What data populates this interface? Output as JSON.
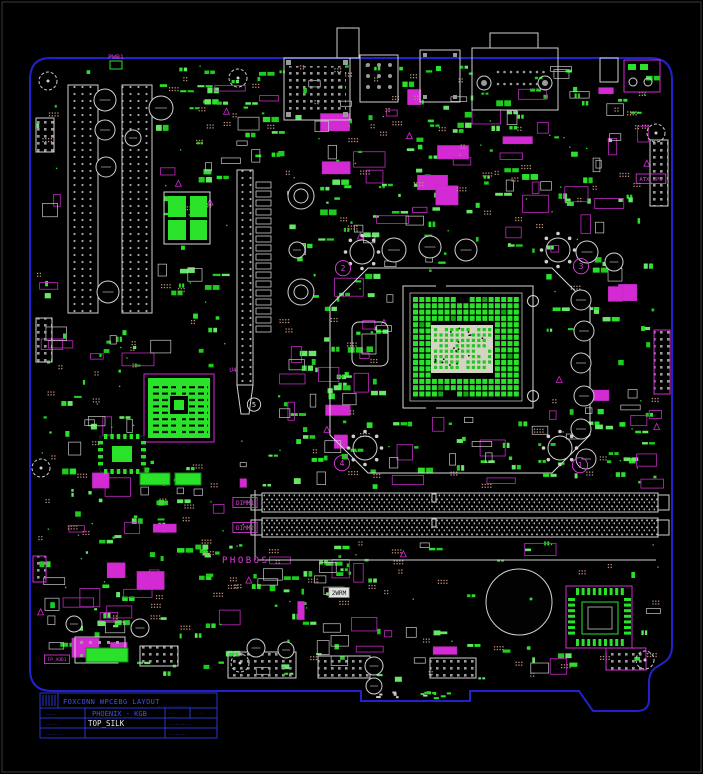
{
  "page": {
    "width": 703,
    "height": 774,
    "background": "#000000",
    "frame_color": "#3a3a3a"
  },
  "colors": {
    "board_outline": "#2222cc",
    "title_blue": "#2a35d0",
    "title_text": "#4050f5",
    "silk_white": "#d4d4d4",
    "component_green": "#2be22b",
    "component_green_dim": "#1ec21e",
    "magenta": "#d32ad3",
    "tan_via": "#c08f7a",
    "pin_gray": "#9a9a9a",
    "layer_text_white": "#e8e8e8"
  },
  "title_block": {
    "project": "FOXCONN WPCEBG LAYOUT",
    "project_note": "..............",
    "r2_left": ".....",
    "board": "PHOENIX - KGB",
    "r2_right_a": "....",
    "r2_right_b": "......",
    "r3_left": "......",
    "layer": "TOP_SILK",
    "r3_right": "..........",
    "r4_left": "........",
    "r4_right": "........"
  },
  "labels": [
    {
      "text": "PWB1",
      "x": 116,
      "y": 59,
      "color": "magenta",
      "size": 6.5
    },
    {
      "text": "ATX_CPU",
      "x": 651,
      "y": 181,
      "color": "magenta",
      "size": 5.5,
      "boxed": true
    },
    {
      "text": "DIMM1",
      "x": 245,
      "y": 505,
      "color": "magenta",
      "size": 6,
      "boxed": true
    },
    {
      "text": "DIMM2",
      "x": 245,
      "y": 530,
      "color": "magenta",
      "size": 6,
      "boxed": true
    },
    {
      "text": "PHOBOS",
      "x": 222,
      "y": 563,
      "color": "magenta",
      "size": 9,
      "spacing": 2.5,
      "anchor": "start"
    },
    {
      "text": "FP_AUD1",
      "x": 57,
      "y": 661,
      "color": "magenta",
      "size": 4.5,
      "boxed": true
    },
    {
      "text": "U4",
      "x": 233,
      "y": 372,
      "color": "magenta",
      "size": 6
    },
    {
      "text": "2WRM",
      "x": 339,
      "y": 595,
      "color": "black",
      "size": 6,
      "boxed": true,
      "bg": "white"
    },
    {
      "text": "5",
      "x": 254,
      "y": 407,
      "color": "white",
      "size": 7,
      "circle": true
    },
    {
      "text": "2",
      "x": 343,
      "y": 271,
      "color": "magenta",
      "size": 8,
      "circle": true
    },
    {
      "text": "3",
      "x": 581,
      "y": 269,
      "color": "magenta",
      "size": 8,
      "circle": true
    },
    {
      "text": "4",
      "x": 342,
      "y": 466,
      "color": "magenta",
      "size": 8,
      "circle": true
    },
    {
      "text": "1",
      "x": 580,
      "y": 468,
      "color": "magenta",
      "size": 8,
      "circle": true
    }
  ]
}
